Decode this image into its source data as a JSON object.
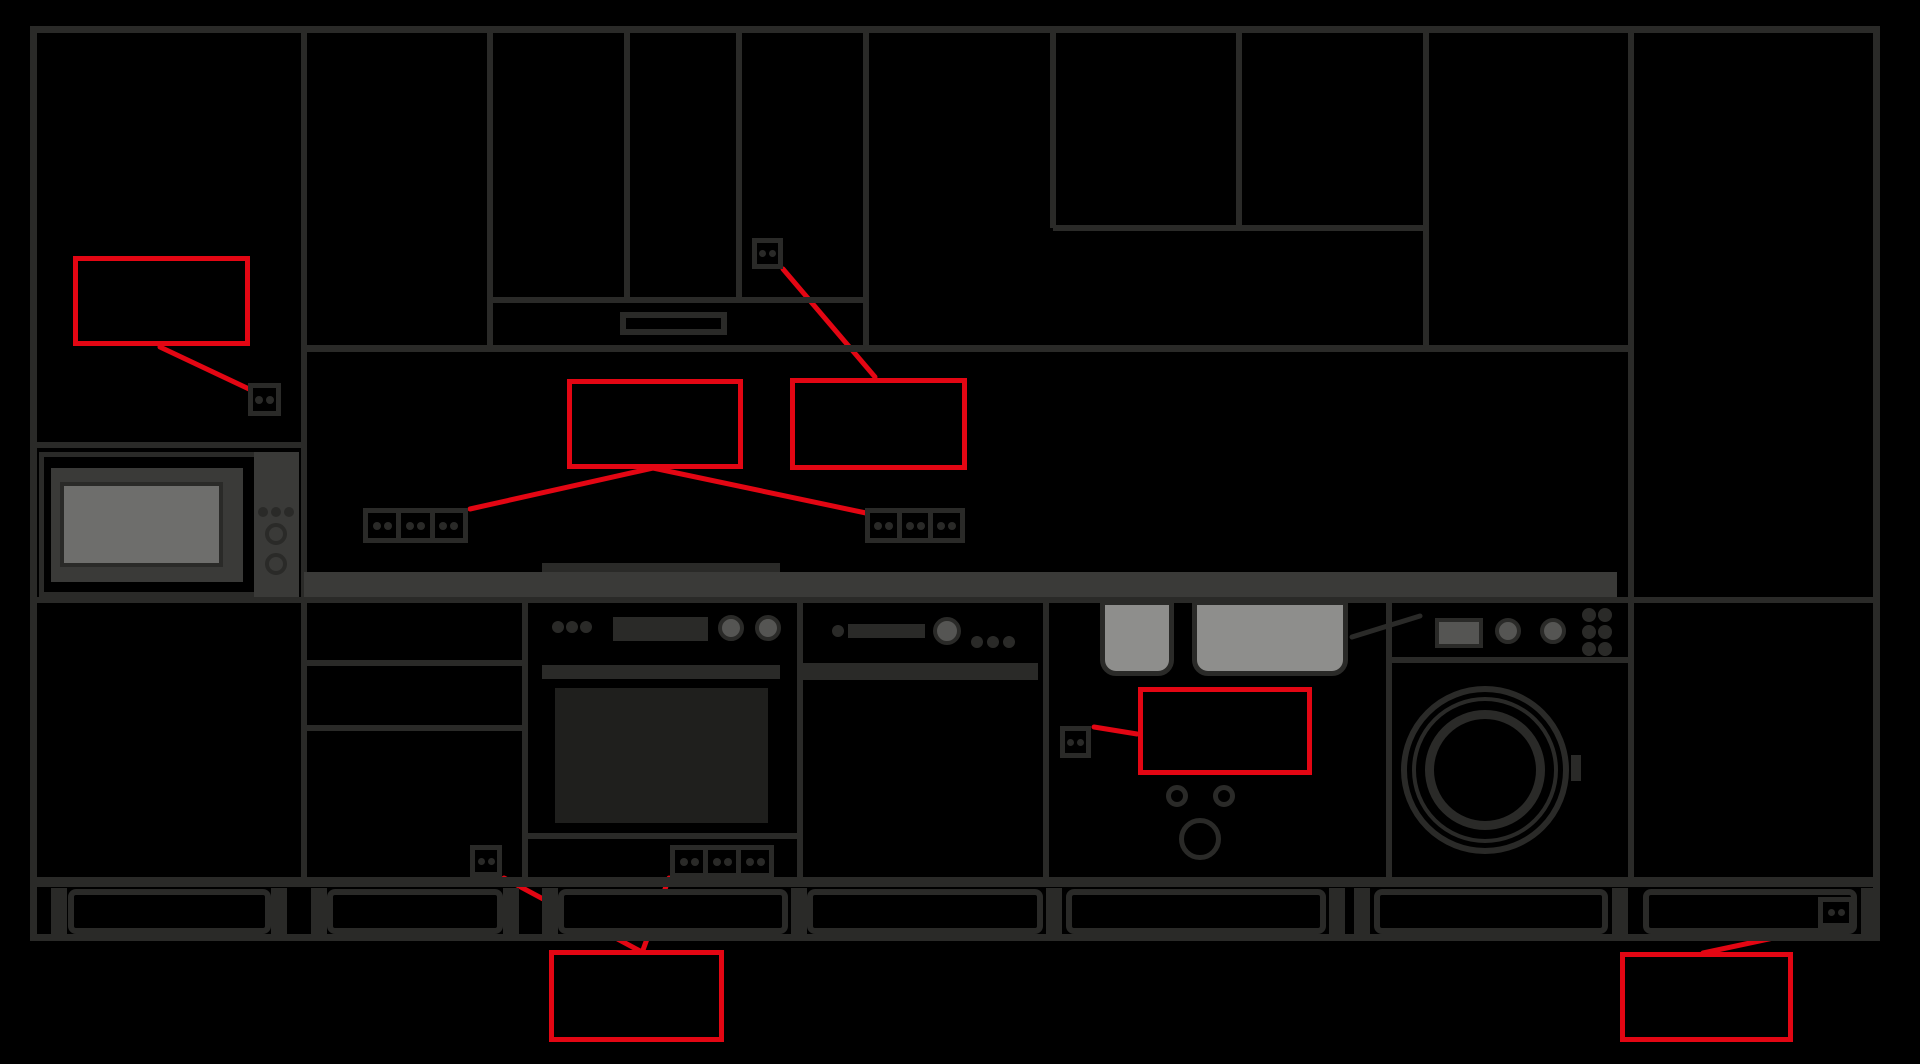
{
  "canvas": {
    "width": 1920,
    "height": 1064,
    "background": "#000000"
  },
  "colors": {
    "line": "#2a2a28",
    "countertop": "#3a3a38",
    "appliance_panel": "#3a3a38",
    "knob_gray": "#555553",
    "microwave_window": "#6e6e6c",
    "sink_bowl": "#8e8e8c",
    "oven_window": "#1f1f1d",
    "annotation_red": "#e30613"
  },
  "diagram": {
    "type": "kitchen-elevation-with-socket-annotations",
    "annotation_boxes_text": [
      "",
      "",
      "",
      "",
      "",
      ""
    ]
  },
  "rects": [
    {
      "name": "wall-top-line",
      "x": 30,
      "y": 26,
      "w": 1850,
      "h": 7,
      "f": "#2a2a28"
    },
    {
      "name": "wall-left-line",
      "x": 30,
      "y": 26,
      "w": 7,
      "h": 915,
      "f": "#2a2a28"
    },
    {
      "name": "wall-right-line",
      "x": 1873,
      "y": 26,
      "w": 7,
      "h": 915,
      "f": "#2a2a28"
    },
    {
      "name": "tall-left-cabinet-divider",
      "x": 301,
      "y": 26,
      "w": 6,
      "h": 851,
      "f": "#2a2a28"
    },
    {
      "name": "wallcab-b-divider",
      "x": 487,
      "y": 26,
      "w": 6,
      "h": 322,
      "f": "#2a2a28"
    },
    {
      "name": "wallcab-door-divider-1",
      "x": 624,
      "y": 26,
      "w": 6,
      "h": 274,
      "f": "#2a2a28"
    },
    {
      "name": "wallcab-door-divider-2",
      "x": 736,
      "y": 26,
      "w": 6,
      "h": 274,
      "f": "#2a2a28"
    },
    {
      "name": "wallcab-c-divider",
      "x": 863,
      "y": 26,
      "w": 6,
      "h": 325,
      "f": "#2a2a28"
    },
    {
      "name": "wallcab-d-divider-1",
      "x": 1050,
      "y": 26,
      "w": 6,
      "h": 202,
      "f": "#2a2a28"
    },
    {
      "name": "wallcab-d-divider-2",
      "x": 1236,
      "y": 26,
      "w": 6,
      "h": 202,
      "f": "#2a2a28"
    },
    {
      "name": "wallcab-e-divider",
      "x": 1423,
      "y": 26,
      "w": 6,
      "h": 325,
      "f": "#2a2a28"
    },
    {
      "name": "tall-right-cabinet-divider",
      "x": 1628,
      "y": 26,
      "w": 6,
      "h": 851,
      "f": "#2a2a28"
    },
    {
      "name": "wallcab-doors-bottom-line",
      "x": 490,
      "y": 297,
      "w": 379,
      "h": 6,
      "f": "#2a2a28"
    },
    {
      "name": "upper-right-split-line",
      "x": 1053,
      "y": 225,
      "w": 376,
      "h": 6,
      "f": "#2a2a28"
    },
    {
      "name": "wall-units-bottom-line",
      "x": 304,
      "y": 345,
      "w": 1330,
      "h": 7,
      "f": "#2a2a28"
    },
    {
      "name": "hood-vent-slot",
      "x": 620,
      "y": 312,
      "w": 107,
      "h": 23,
      "f": "#000000",
      "s": "#2a2a28",
      "sw": 6
    },
    {
      "name": "microwave-shelf-line",
      "x": 30,
      "y": 442,
      "w": 277,
      "h": 6,
      "f": "#2a2a28"
    },
    {
      "name": "microwave-body",
      "x": 39,
      "y": 452,
      "w": 260,
      "h": 145,
      "f": "#000000",
      "s": "#2a2a28",
      "sw": 5
    },
    {
      "name": "microwave-inner-panel",
      "x": 51,
      "y": 468,
      "w": 192,
      "h": 114,
      "f": "#3a3a38"
    },
    {
      "name": "microwave-window",
      "x": 60,
      "y": 482,
      "w": 163,
      "h": 85,
      "f": "#6e6e6c",
      "s": "#2a2a28",
      "sw": 4
    },
    {
      "name": "microwave-control-strip",
      "x": 254,
      "y": 452,
      "w": 45,
      "h": 145,
      "f": "#3a3a38"
    },
    {
      "name": "cooktop-strip",
      "x": 542,
      "y": 563,
      "w": 238,
      "h": 9,
      "f": "#2a2a28"
    },
    {
      "name": "countertop",
      "x": 304,
      "y": 572,
      "w": 1313,
      "h": 25,
      "f": "#3a3a38"
    },
    {
      "name": "counter-base-line",
      "x": 30,
      "y": 597,
      "w": 1850,
      "h": 6,
      "f": "#2a2a28"
    },
    {
      "name": "drawer-line-1",
      "x": 307,
      "y": 660,
      "w": 215,
      "h": 6,
      "f": "#2a2a28"
    },
    {
      "name": "drawer-line-2",
      "x": 307,
      "y": 725,
      "w": 215,
      "h": 6,
      "f": "#2a2a28"
    },
    {
      "name": "oven-left-wall",
      "x": 522,
      "y": 600,
      "w": 6,
      "h": 277,
      "f": "#2a2a28"
    },
    {
      "name": "oven-right-wall",
      "x": 797,
      "y": 600,
      "w": 6,
      "h": 277,
      "f": "#2a2a28"
    },
    {
      "name": "oven-display",
      "x": 613,
      "y": 617,
      "w": 95,
      "h": 24,
      "f": "#2a2a28"
    },
    {
      "name": "oven-handle",
      "x": 542,
      "y": 665,
      "w": 238,
      "h": 14,
      "f": "#2a2a28"
    },
    {
      "name": "oven-window",
      "x": 555,
      "y": 688,
      "w": 213,
      "h": 135,
      "f": "#1f1f1d"
    },
    {
      "name": "oven-bottom-line",
      "x": 528,
      "y": 833,
      "w": 269,
      "h": 6,
      "f": "#2a2a28"
    },
    {
      "name": "dishwasher-right-wall",
      "x": 1043,
      "y": 600,
      "w": 6,
      "h": 277,
      "f": "#2a2a28"
    },
    {
      "name": "dishwasher-display-bar",
      "x": 848,
      "y": 624,
      "w": 77,
      "h": 14,
      "f": "#2a2a28"
    },
    {
      "name": "dishwasher-top-band",
      "x": 800,
      "y": 663,
      "w": 238,
      "h": 17,
      "f": "#2a2a28"
    },
    {
      "name": "sink-bowl-left",
      "x": 1100,
      "y": 600,
      "w": 74,
      "h": 76,
      "f": "#8e8e8c",
      "s": "#2a2a28",
      "sw": 5,
      "rr": "0 0 16px 16px"
    },
    {
      "name": "sink-bowl-right",
      "x": 1192,
      "y": 600,
      "w": 156,
      "h": 76,
      "f": "#8e8e8c",
      "s": "#2a2a28",
      "sw": 5,
      "rr": "0 0 16px 16px"
    },
    {
      "name": "sink-right-wall",
      "x": 1386,
      "y": 600,
      "w": 6,
      "h": 277,
      "f": "#2a2a28"
    },
    {
      "name": "washer-display",
      "x": 1435,
      "y": 618,
      "w": 48,
      "h": 30,
      "f": "#555553",
      "s": "#2a2a28",
      "sw": 4
    },
    {
      "name": "washer-panel-line",
      "x": 1392,
      "y": 657,
      "w": 236,
      "h": 6,
      "f": "#2a2a28"
    },
    {
      "name": "washer-door-handle",
      "x": 1571,
      "y": 755,
      "w": 10,
      "h": 26,
      "f": "#2a2a28"
    },
    {
      "name": "base-cabinets-bottom-line",
      "x": 30,
      "y": 877,
      "w": 1850,
      "h": 10,
      "f": "#2a2a28"
    },
    {
      "name": "plinth-foot",
      "x": 51,
      "y": 888,
      "w": 16,
      "h": 46,
      "f": "#2a2a28"
    },
    {
      "name": "plinth-foot",
      "x": 271,
      "y": 888,
      "w": 16,
      "h": 46,
      "f": "#2a2a28"
    },
    {
      "name": "plinth-foot",
      "x": 311,
      "y": 888,
      "w": 16,
      "h": 46,
      "f": "#2a2a28"
    },
    {
      "name": "plinth-foot",
      "x": 503,
      "y": 888,
      "w": 16,
      "h": 46,
      "f": "#2a2a28"
    },
    {
      "name": "plinth-foot",
      "x": 542,
      "y": 888,
      "w": 16,
      "h": 46,
      "f": "#2a2a28"
    },
    {
      "name": "plinth-foot",
      "x": 791,
      "y": 888,
      "w": 16,
      "h": 46,
      "f": "#2a2a28"
    },
    {
      "name": "plinth-foot",
      "x": 1046,
      "y": 888,
      "w": 16,
      "h": 46,
      "f": "#2a2a28"
    },
    {
      "name": "plinth-foot",
      "x": 1329,
      "y": 888,
      "w": 16,
      "h": 46,
      "f": "#2a2a28"
    },
    {
      "name": "plinth-foot",
      "x": 1354,
      "y": 888,
      "w": 16,
      "h": 46,
      "f": "#2a2a28"
    },
    {
      "name": "plinth-foot",
      "x": 1612,
      "y": 888,
      "w": 16,
      "h": 46,
      "f": "#2a2a28"
    },
    {
      "name": "plinth-foot",
      "x": 1861,
      "y": 888,
      "w": 12,
      "h": 46,
      "f": "#2a2a28"
    },
    {
      "name": "plinth-panel",
      "x": 68,
      "y": 889,
      "w": 203,
      "h": 45,
      "f": "#000000",
      "s": "#2a2a28",
      "sw": 6,
      "rr": "8px"
    },
    {
      "name": "plinth-panel",
      "x": 327,
      "y": 889,
      "w": 176,
      "h": 45,
      "f": "#000000",
      "s": "#2a2a28",
      "sw": 6,
      "rr": "8px"
    },
    {
      "name": "plinth-panel",
      "x": 558,
      "y": 889,
      "w": 230,
      "h": 45,
      "f": "#000000",
      "s": "#2a2a28",
      "sw": 6,
      "rr": "8px"
    },
    {
      "name": "plinth-panel",
      "x": 807,
      "y": 889,
      "w": 236,
      "h": 45,
      "f": "#000000",
      "s": "#2a2a28",
      "sw": 6,
      "rr": "8px"
    },
    {
      "name": "plinth-panel",
      "x": 1066,
      "y": 889,
      "w": 260,
      "h": 45,
      "f": "#000000",
      "s": "#2a2a28",
      "sw": 6,
      "rr": "8px"
    },
    {
      "name": "plinth-panel",
      "x": 1374,
      "y": 889,
      "w": 234,
      "h": 45,
      "f": "#000000",
      "s": "#2a2a28",
      "sw": 6,
      "rr": "8px"
    },
    {
      "name": "plinth-panel",
      "x": 1643,
      "y": 889,
      "w": 214,
      "h": 45,
      "f": "#000000",
      "s": "#2a2a28",
      "sw": 6,
      "rr": "8px"
    },
    {
      "name": "floor-line",
      "x": 30,
      "y": 934,
      "w": 1850,
      "h": 7,
      "f": "#2a2a28"
    }
  ],
  "circles": [
    {
      "name": "microwave-indicator-dot",
      "cx": 263,
      "cy": 512,
      "r": 5,
      "f": "#2a2a28"
    },
    {
      "name": "microwave-indicator-dot",
      "cx": 276,
      "cy": 512,
      "r": 5,
      "f": "#2a2a28"
    },
    {
      "name": "microwave-indicator-dot",
      "cx": 289,
      "cy": 512,
      "r": 5,
      "f": "#2a2a28"
    },
    {
      "name": "microwave-knob",
      "cx": 276,
      "cy": 534,
      "r": 11,
      "s": "#2a2a28",
      "sw": 4
    },
    {
      "name": "microwave-knob",
      "cx": 276,
      "cy": 564,
      "r": 11,
      "s": "#2a2a28",
      "sw": 4
    },
    {
      "name": "oven-indicator-dot",
      "cx": 558,
      "cy": 627,
      "r": 6,
      "f": "#2a2a28"
    },
    {
      "name": "oven-indicator-dot",
      "cx": 572,
      "cy": 627,
      "r": 6,
      "f": "#2a2a28"
    },
    {
      "name": "oven-indicator-dot",
      "cx": 586,
      "cy": 627,
      "r": 6,
      "f": "#2a2a28"
    },
    {
      "name": "oven-knob",
      "cx": 731,
      "cy": 628,
      "r": 13,
      "f": "#555553",
      "s": "#2a2a28",
      "sw": 4
    },
    {
      "name": "oven-knob",
      "cx": 768,
      "cy": 628,
      "r": 13,
      "f": "#555553",
      "s": "#2a2a28",
      "sw": 4
    },
    {
      "name": "dishwasher-indicator-dot",
      "cx": 838,
      "cy": 631,
      "r": 6,
      "f": "#2a2a28"
    },
    {
      "name": "dishwasher-knob",
      "cx": 947,
      "cy": 631,
      "r": 14,
      "f": "#555553",
      "s": "#2a2a28",
      "sw": 4
    },
    {
      "name": "dishwasher-indicator-dot",
      "cx": 977,
      "cy": 642,
      "r": 6,
      "f": "#2a2a28"
    },
    {
      "name": "dishwasher-indicator-dot",
      "cx": 993,
      "cy": 642,
      "r": 6,
      "f": "#2a2a28"
    },
    {
      "name": "dishwasher-indicator-dot",
      "cx": 1009,
      "cy": 642,
      "r": 6,
      "f": "#2a2a28"
    },
    {
      "name": "sink-cabinet-knob",
      "cx": 1177,
      "cy": 796,
      "r": 11,
      "s": "#2a2a28",
      "sw": 5
    },
    {
      "name": "sink-cabinet-knob",
      "cx": 1224,
      "cy": 796,
      "r": 11,
      "s": "#2a2a28",
      "sw": 5
    },
    {
      "name": "sink-drain-circle",
      "cx": 1200,
      "cy": 839,
      "r": 21,
      "s": "#2a2a28",
      "sw": 5
    },
    {
      "name": "washer-knob",
      "cx": 1508,
      "cy": 631,
      "r": 13,
      "f": "#555553",
      "s": "#2a2a28",
      "sw": 4
    },
    {
      "name": "washer-knob",
      "cx": 1553,
      "cy": 631,
      "r": 13,
      "f": "#555553",
      "s": "#2a2a28",
      "sw": 4
    },
    {
      "name": "washer-button-dot",
      "cx": 1589,
      "cy": 615,
      "r": 7,
      "f": "#2a2a28"
    },
    {
      "name": "washer-button-dot",
      "cx": 1605,
      "cy": 615,
      "r": 7,
      "f": "#2a2a28"
    },
    {
      "name": "washer-button-dot",
      "cx": 1589,
      "cy": 632,
      "r": 7,
      "f": "#2a2a28"
    },
    {
      "name": "washer-button-dot",
      "cx": 1605,
      "cy": 632,
      "r": 7,
      "f": "#2a2a28"
    },
    {
      "name": "washer-button-dot",
      "cx": 1589,
      "cy": 649,
      "r": 7,
      "f": "#2a2a28"
    },
    {
      "name": "washer-button-dot",
      "cx": 1605,
      "cy": 649,
      "r": 7,
      "f": "#2a2a28"
    },
    {
      "name": "washer-door-outer-ring",
      "cx": 1485,
      "cy": 770,
      "r": 84,
      "s": "#2a2a28",
      "sw": 6
    },
    {
      "name": "washer-door-mid-ring",
      "cx": 1485,
      "cy": 770,
      "r": 73,
      "s": "#2a2a28",
      "sw": 4
    },
    {
      "name": "washer-door-inner-ring",
      "cx": 1485,
      "cy": 770,
      "r": 60,
      "s": "#2a2a28",
      "sw": 9
    }
  ],
  "outlets": [
    {
      "name": "outlet-tall-left",
      "x": 248,
      "y": 383,
      "w": 33,
      "h": 33,
      "gang": 1
    },
    {
      "name": "outlet-wallcab-top",
      "x": 752,
      "y": 238,
      "w": 31,
      "h": 31,
      "gang": 1
    },
    {
      "name": "outlet-backsplash-left",
      "x": 363,
      "y": 508,
      "w": 105,
      "h": 35,
      "gang": 3
    },
    {
      "name": "outlet-backsplash-right",
      "x": 865,
      "y": 508,
      "w": 100,
      "h": 35,
      "gang": 3
    },
    {
      "name": "outlet-base-single",
      "x": 470,
      "y": 845,
      "w": 32,
      "h": 32,
      "gang": 1
    },
    {
      "name": "outlet-base-strip",
      "x": 670,
      "y": 845,
      "w": 104,
      "h": 33,
      "gang": 3
    },
    {
      "name": "outlet-sink-cabinet",
      "x": 1060,
      "y": 726,
      "w": 31,
      "h": 32,
      "gang": 1
    },
    {
      "name": "outlet-plinth-right",
      "x": 1818,
      "y": 897,
      "w": 36,
      "h": 31,
      "gang": 1
    }
  ],
  "red_boxes": [
    {
      "name": "annotation-box-tall-left",
      "x": 73,
      "y": 256,
      "w": 177,
      "h": 90
    },
    {
      "name": "annotation-box-backsplash-left",
      "x": 567,
      "y": 379,
      "w": 176,
      "h": 90
    },
    {
      "name": "annotation-box-backsplash-right",
      "x": 790,
      "y": 378,
      "w": 177,
      "h": 92
    },
    {
      "name": "annotation-box-sink",
      "x": 1138,
      "y": 687,
      "w": 174,
      "h": 88
    },
    {
      "name": "annotation-box-base",
      "x": 549,
      "y": 950,
      "w": 175,
      "h": 92
    },
    {
      "name": "annotation-box-plinth-right",
      "x": 1620,
      "y": 952,
      "w": 173,
      "h": 90
    }
  ],
  "svg_lines": [
    {
      "name": "leader-tall-left",
      "x1": 160,
      "y1": 347,
      "x2": 249,
      "y2": 389,
      "c": "#e30613",
      "w": 5
    },
    {
      "name": "leader-wallcab-top",
      "x1": 783,
      "y1": 269,
      "x2": 875,
      "y2": 377,
      "c": "#e30613",
      "w": 5
    },
    {
      "name": "leader-backsplash-left",
      "x1": 653,
      "y1": 468,
      "x2": 470,
      "y2": 509,
      "c": "#e30613",
      "w": 5
    },
    {
      "name": "leader-backsplash-right",
      "x1": 653,
      "y1": 468,
      "x2": 866,
      "y2": 513,
      "c": "#e30613",
      "w": 5
    },
    {
      "name": "leader-base-single",
      "x1": 504,
      "y1": 878,
      "x2": 640,
      "y2": 951,
      "c": "#e30613",
      "w": 5
    },
    {
      "name": "leader-base-strip",
      "x1": 669,
      "y1": 878,
      "x2": 643,
      "y2": 950,
      "c": "#e30613",
      "w": 5
    },
    {
      "name": "leader-sink",
      "x1": 1094,
      "y1": 727,
      "x2": 1137,
      "y2": 734,
      "c": "#e30613",
      "w": 5
    },
    {
      "name": "leader-plinth-right",
      "x1": 1820,
      "y1": 928,
      "x2": 1703,
      "y2": 953,
      "c": "#e30613",
      "w": 5
    },
    {
      "name": "sink-drain-slope",
      "x1": 1352,
      "y1": 637,
      "x2": 1420,
      "y2": 616,
      "c": "#2a2a28",
      "w": 5
    },
    {
      "name": "adjustable-foot-slash",
      "x1": 1394,
      "y1": 926,
      "x2": 1419,
      "y2": 897,
      "c": "#2a2a28",
      "w": 5
    }
  ],
  "svg_circles": [
    {
      "name": "adjustable-foot-circle",
      "cx": 1406,
      "cy": 913,
      "r": 17,
      "c": "#2a2a28",
      "w": 5
    }
  ]
}
